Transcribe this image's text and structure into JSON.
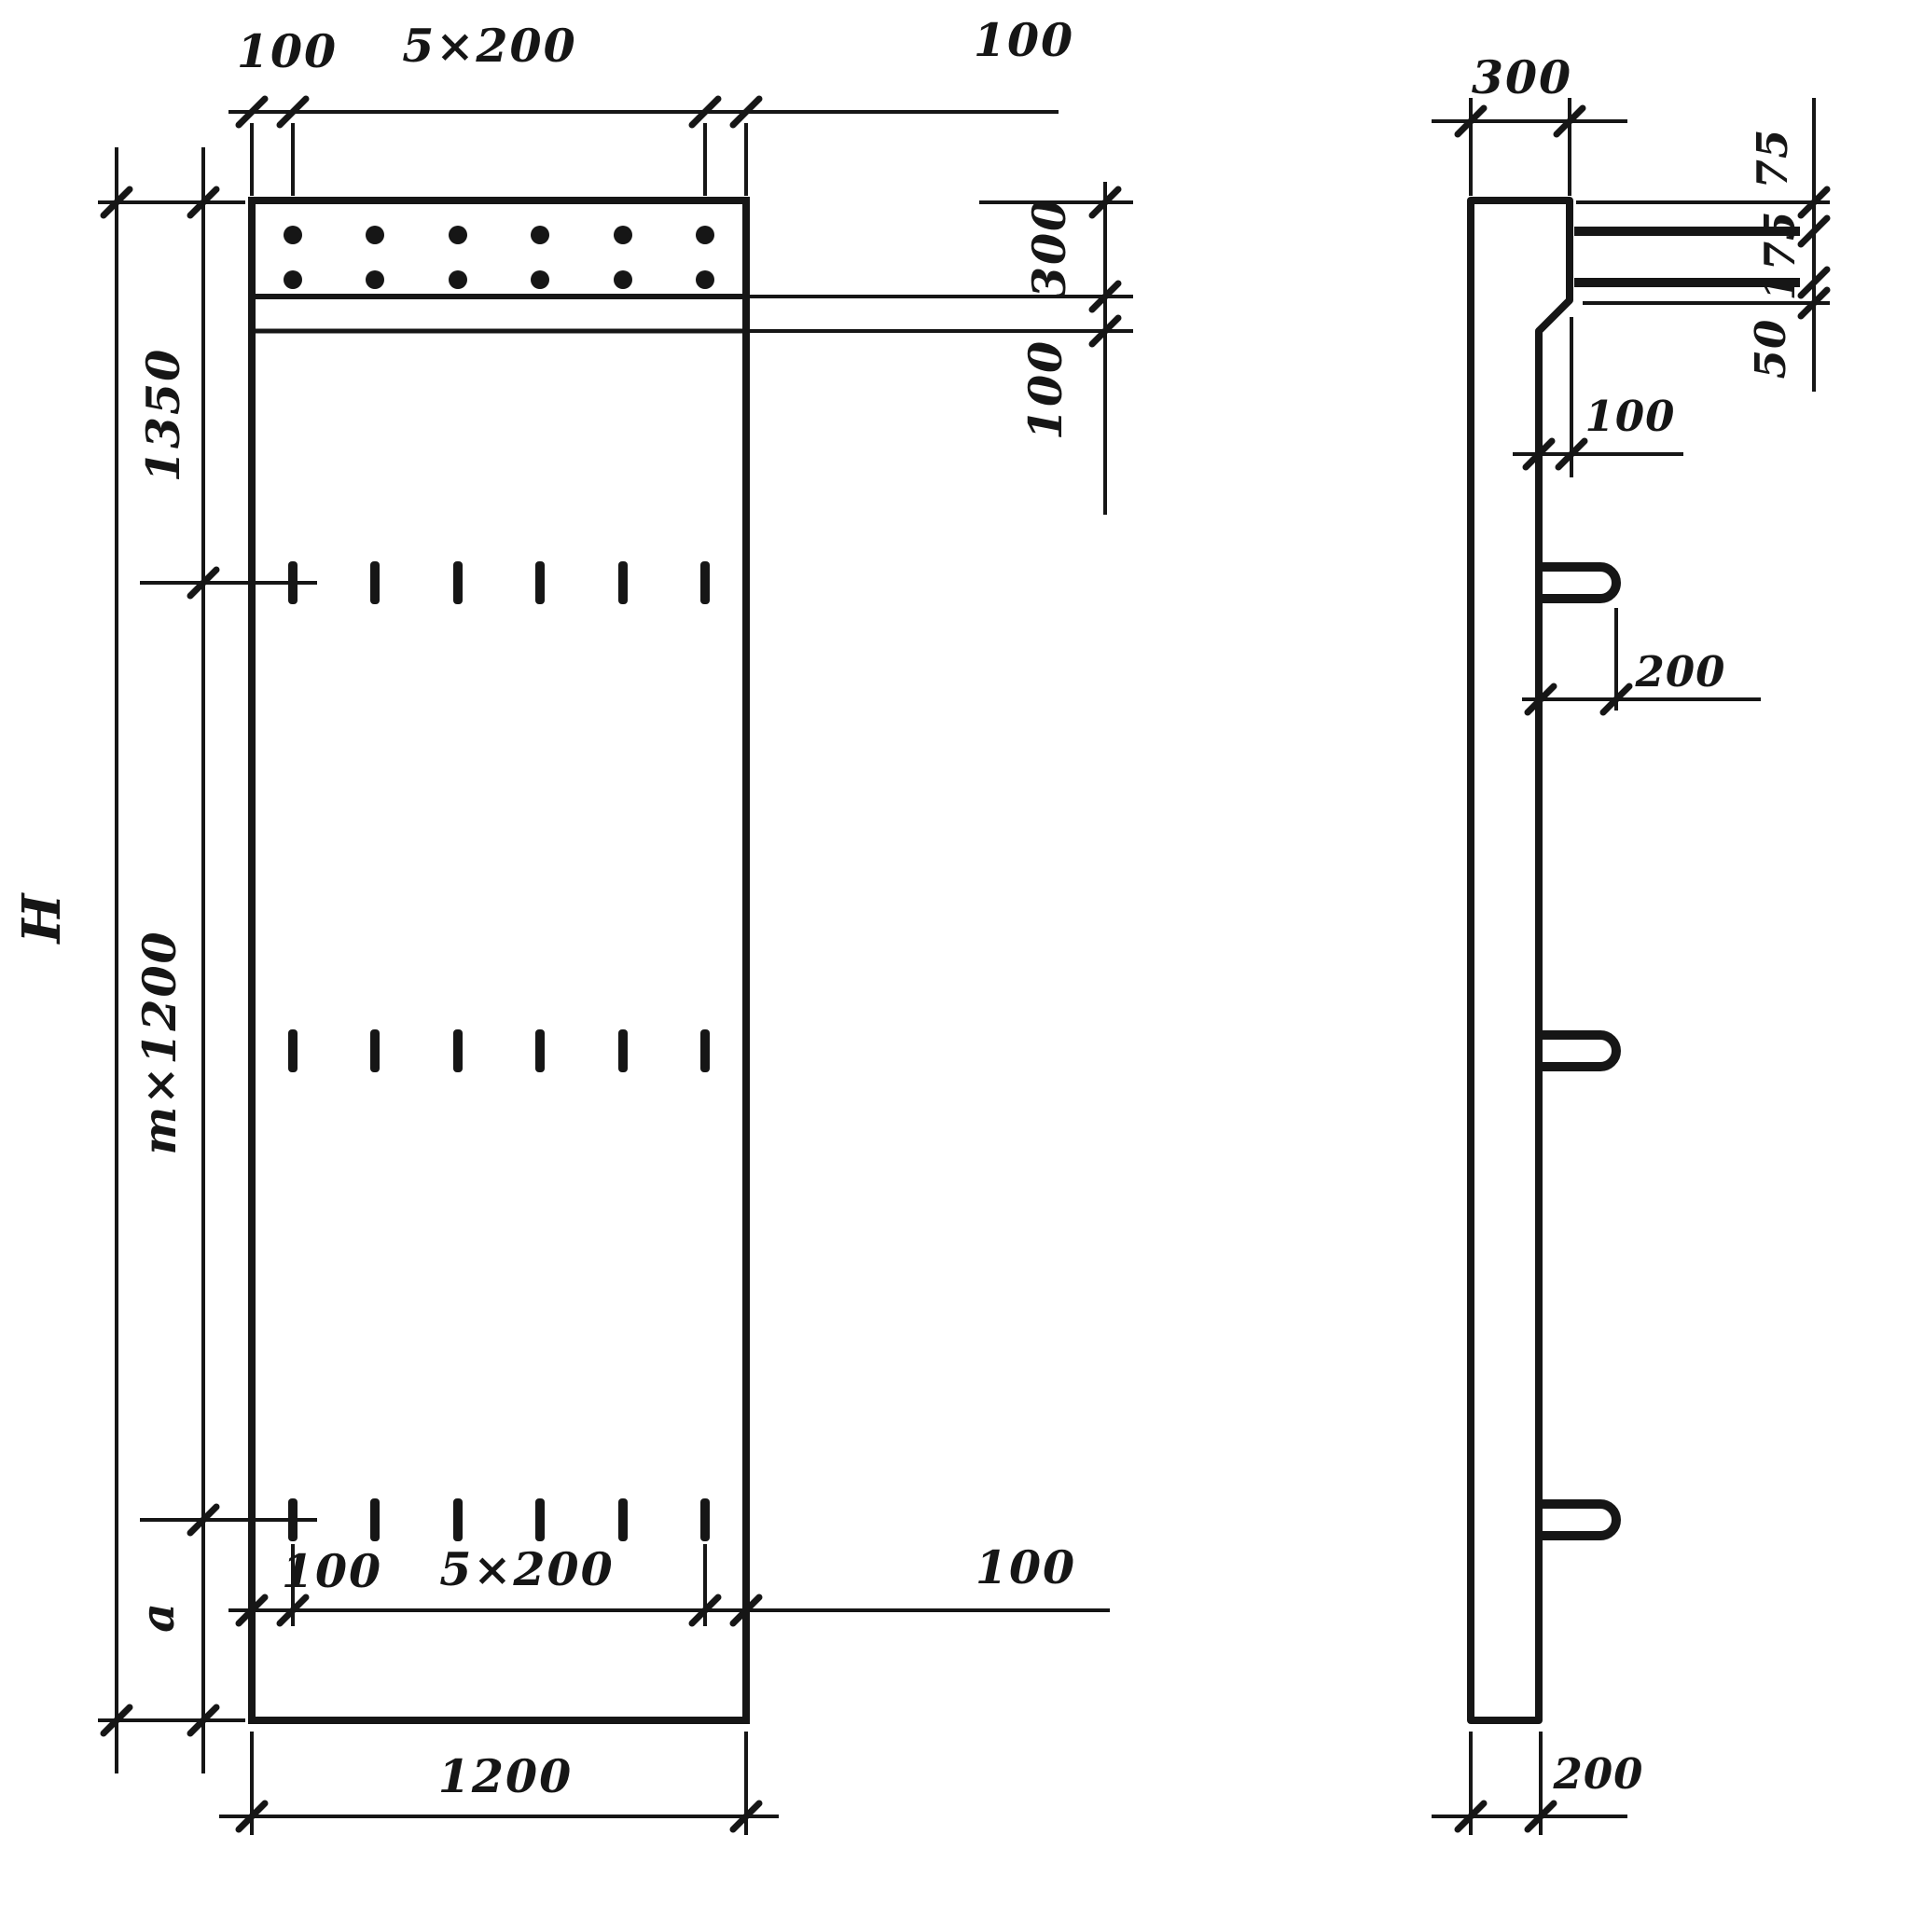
{
  "drawing": {
    "type": "engineering-drawing",
    "views": {
      "front_view_name": "panel front elevation",
      "side_view_name": "panel side elevation"
    },
    "colors": {
      "ink": "#161616",
      "paper": "#ffffff"
    },
    "front": {
      "top": {
        "left": "100",
        "span": "5×200",
        "right": "100"
      },
      "left": {
        "upper": "1350",
        "middle": "m×1200",
        "lower": "a",
        "overall": "H"
      },
      "right": {
        "band": "300",
        "strip": "100"
      },
      "bottom_inner": {
        "left": "100",
        "span": "5×200",
        "right": "100"
      },
      "bottom": {
        "width": "1200"
      }
    },
    "side": {
      "top": {
        "width": "300"
      },
      "right": {
        "gap_top": "75",
        "gap_mid": "175",
        "gap_bottom": "50"
      },
      "step": {
        "offset": "100"
      },
      "loop": {
        "protrusion": "200"
      },
      "bottom": {
        "thickness": "200"
      }
    }
  }
}
